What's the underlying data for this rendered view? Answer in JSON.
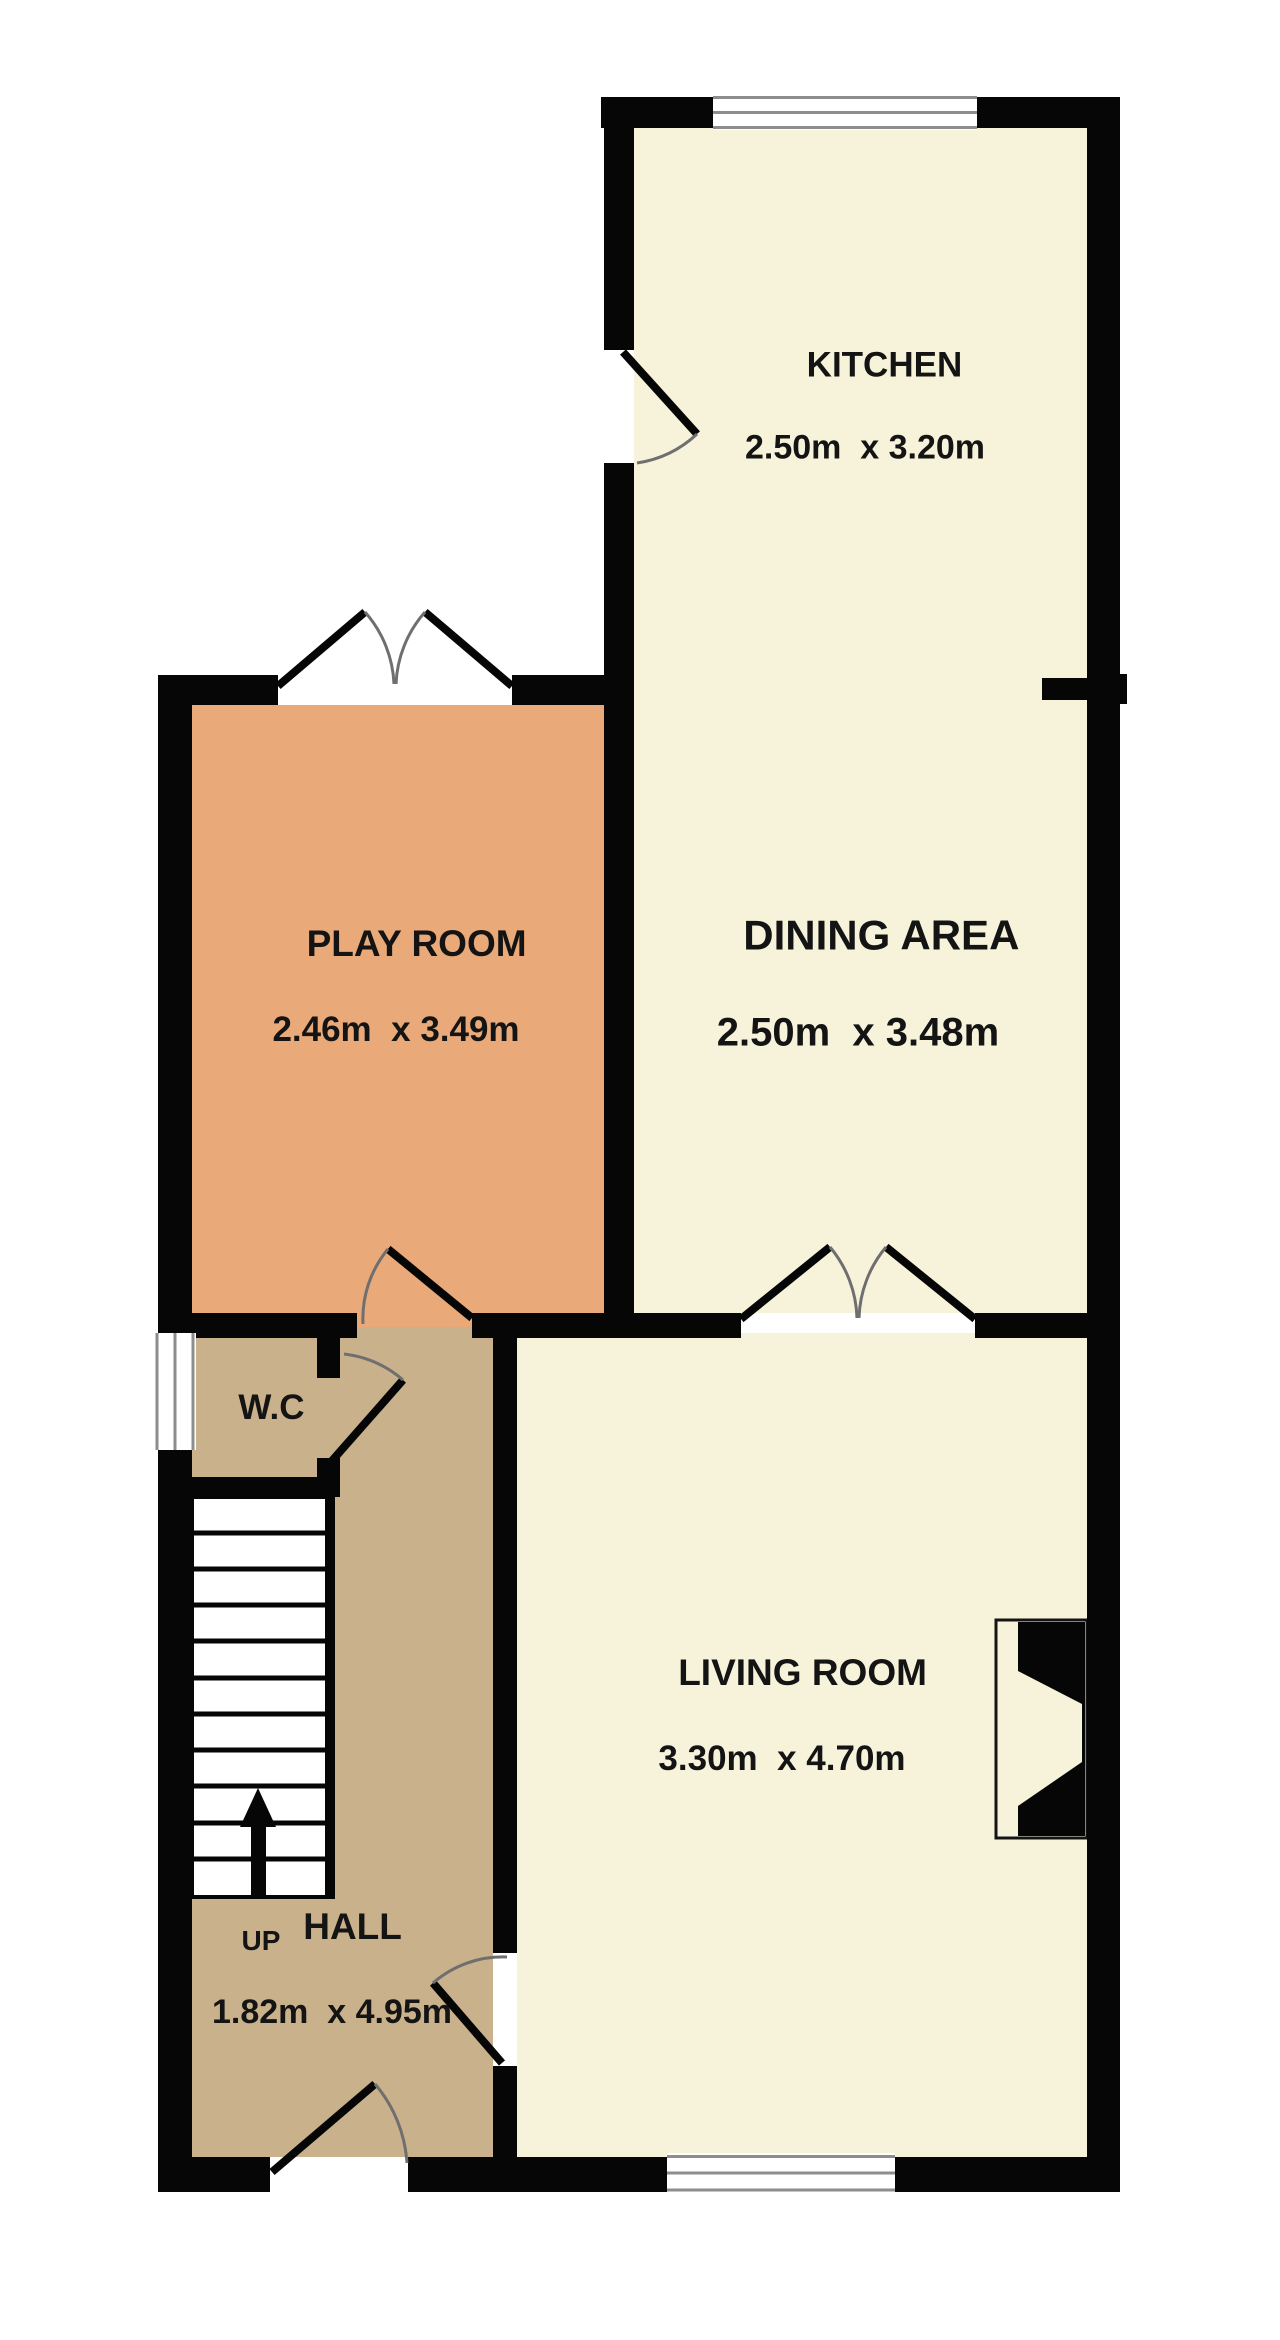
{
  "colors": {
    "background": "#ffffff",
    "room_cream": "#f7f3da",
    "room_orange": "#e9a978",
    "room_tan": "#c9b18c",
    "wall": "#060606",
    "door_arc": "#6f6f6f",
    "window_line": "#8d8d8d",
    "label_text": "#141414"
  },
  "rooms": [
    {
      "id": "kitchen",
      "name": "KITCHEN",
      "dimensions": "2.50m  x 3.20m"
    },
    {
      "id": "dining",
      "name": "DINING AREA",
      "dimensions": "2.50m  x 3.48m"
    },
    {
      "id": "play",
      "name": "PLAY ROOM",
      "dimensions": "2.46m  x 3.49m"
    },
    {
      "id": "wc",
      "name": "W.C",
      "dimensions": ""
    },
    {
      "id": "hall",
      "name": "HALL",
      "dimensions": "1.82m  x 4.95m"
    },
    {
      "id": "living",
      "name": "LIVING ROOM",
      "dimensions": "3.30m  x 4.70m"
    }
  ],
  "stairs": {
    "label": "UP",
    "direction": "up",
    "treads": 11
  },
  "features": [
    "fireplace",
    "kitchen-window",
    "wc-window",
    "living-room-window",
    "front-door",
    "kitchen-door",
    "wc-door",
    "playroom-double-doors",
    "dining-living-double-doors",
    "playroom-hall-door",
    "hall-living-door"
  ]
}
